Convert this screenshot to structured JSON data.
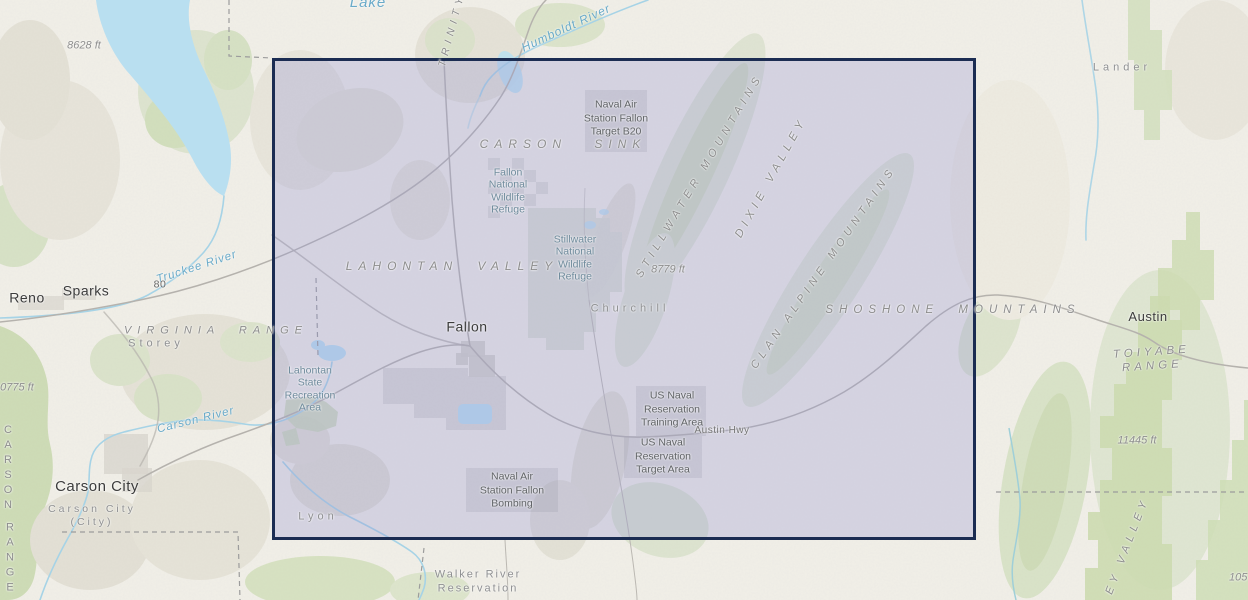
{
  "colors": {
    "selection_border": "#1b2c52",
    "selection_fill": "rgba(150,150,212,0.30)",
    "water": "#b9dff0",
    "water_line": "#a6d3e6",
    "forest": "#cddcb0",
    "terrain_bg": "#f1efe8"
  },
  "map": {
    "labels": {
      "lake_partial": "Lake",
      "elev_8628": "8628 ft",
      "trinity_range": "TRINITY",
      "humboldt_river": "Humboldt River",
      "naval_target_b20": "Naval Air\nStation Fallon\nTarget B20",
      "carson_sink": "CARSON SINK",
      "fallon_nwr": "Fallon\nNational\nWildlife\nRefuge",
      "stillwater_nwr": "Stillwater\nNational\nWildlife\nRefuge",
      "lahontan_valley": "LAHONTAN VALLEY",
      "stillwater_mountains": "STILLWATER MOUNTAINS",
      "dixie_valley": "DIXIE VALLEY",
      "clan_alpine_mountains": "CLAN ALPINE MOUNTAINS",
      "elev_8779": "8779 ft",
      "shoshone_mountains": "SHOSHONE MOUNTAINS",
      "churchill_county": "Churchill",
      "fallon_city": "Fallon",
      "lahontan_sra": "Lahontan\nState\nRecreation\nArea",
      "us_naval_training": "US Naval\nReservation\nTraining Area",
      "austin_hwy": "Austin Hwy",
      "us_naval_target": "US Naval\nReservation\nTarget Area",
      "naval_bombing": "Naval Air\nStation Fallon\nBombing",
      "lyon_county": "Lyon",
      "walker_river_reservation": "Walker River\nReservation",
      "reno_city": "Reno",
      "sparks_city": "Sparks",
      "truckee_river": "Truckee River",
      "interstate_80": "80",
      "virginia_range": "VIRGINIA RANGE",
      "storey_county": "Storey",
      "carson_city": "Carson City",
      "carson_city_county": "Carson City\n(City)",
      "carson_river": "Carson River",
      "carson_range_word1": "C\nA\nR\nS\nO\nN",
      "carson_range_word2": "R\nA\nN\nG\nE",
      "austin_city": "Austin",
      "toiyabe_range": "TOIYABE RANGE",
      "elev_11445": "11445 ft",
      "lander_county": "Lander",
      "valley_partial": "EY VALLEY",
      "elev_partial_105": "105",
      "elev_10775": "10775 ft"
    }
  }
}
